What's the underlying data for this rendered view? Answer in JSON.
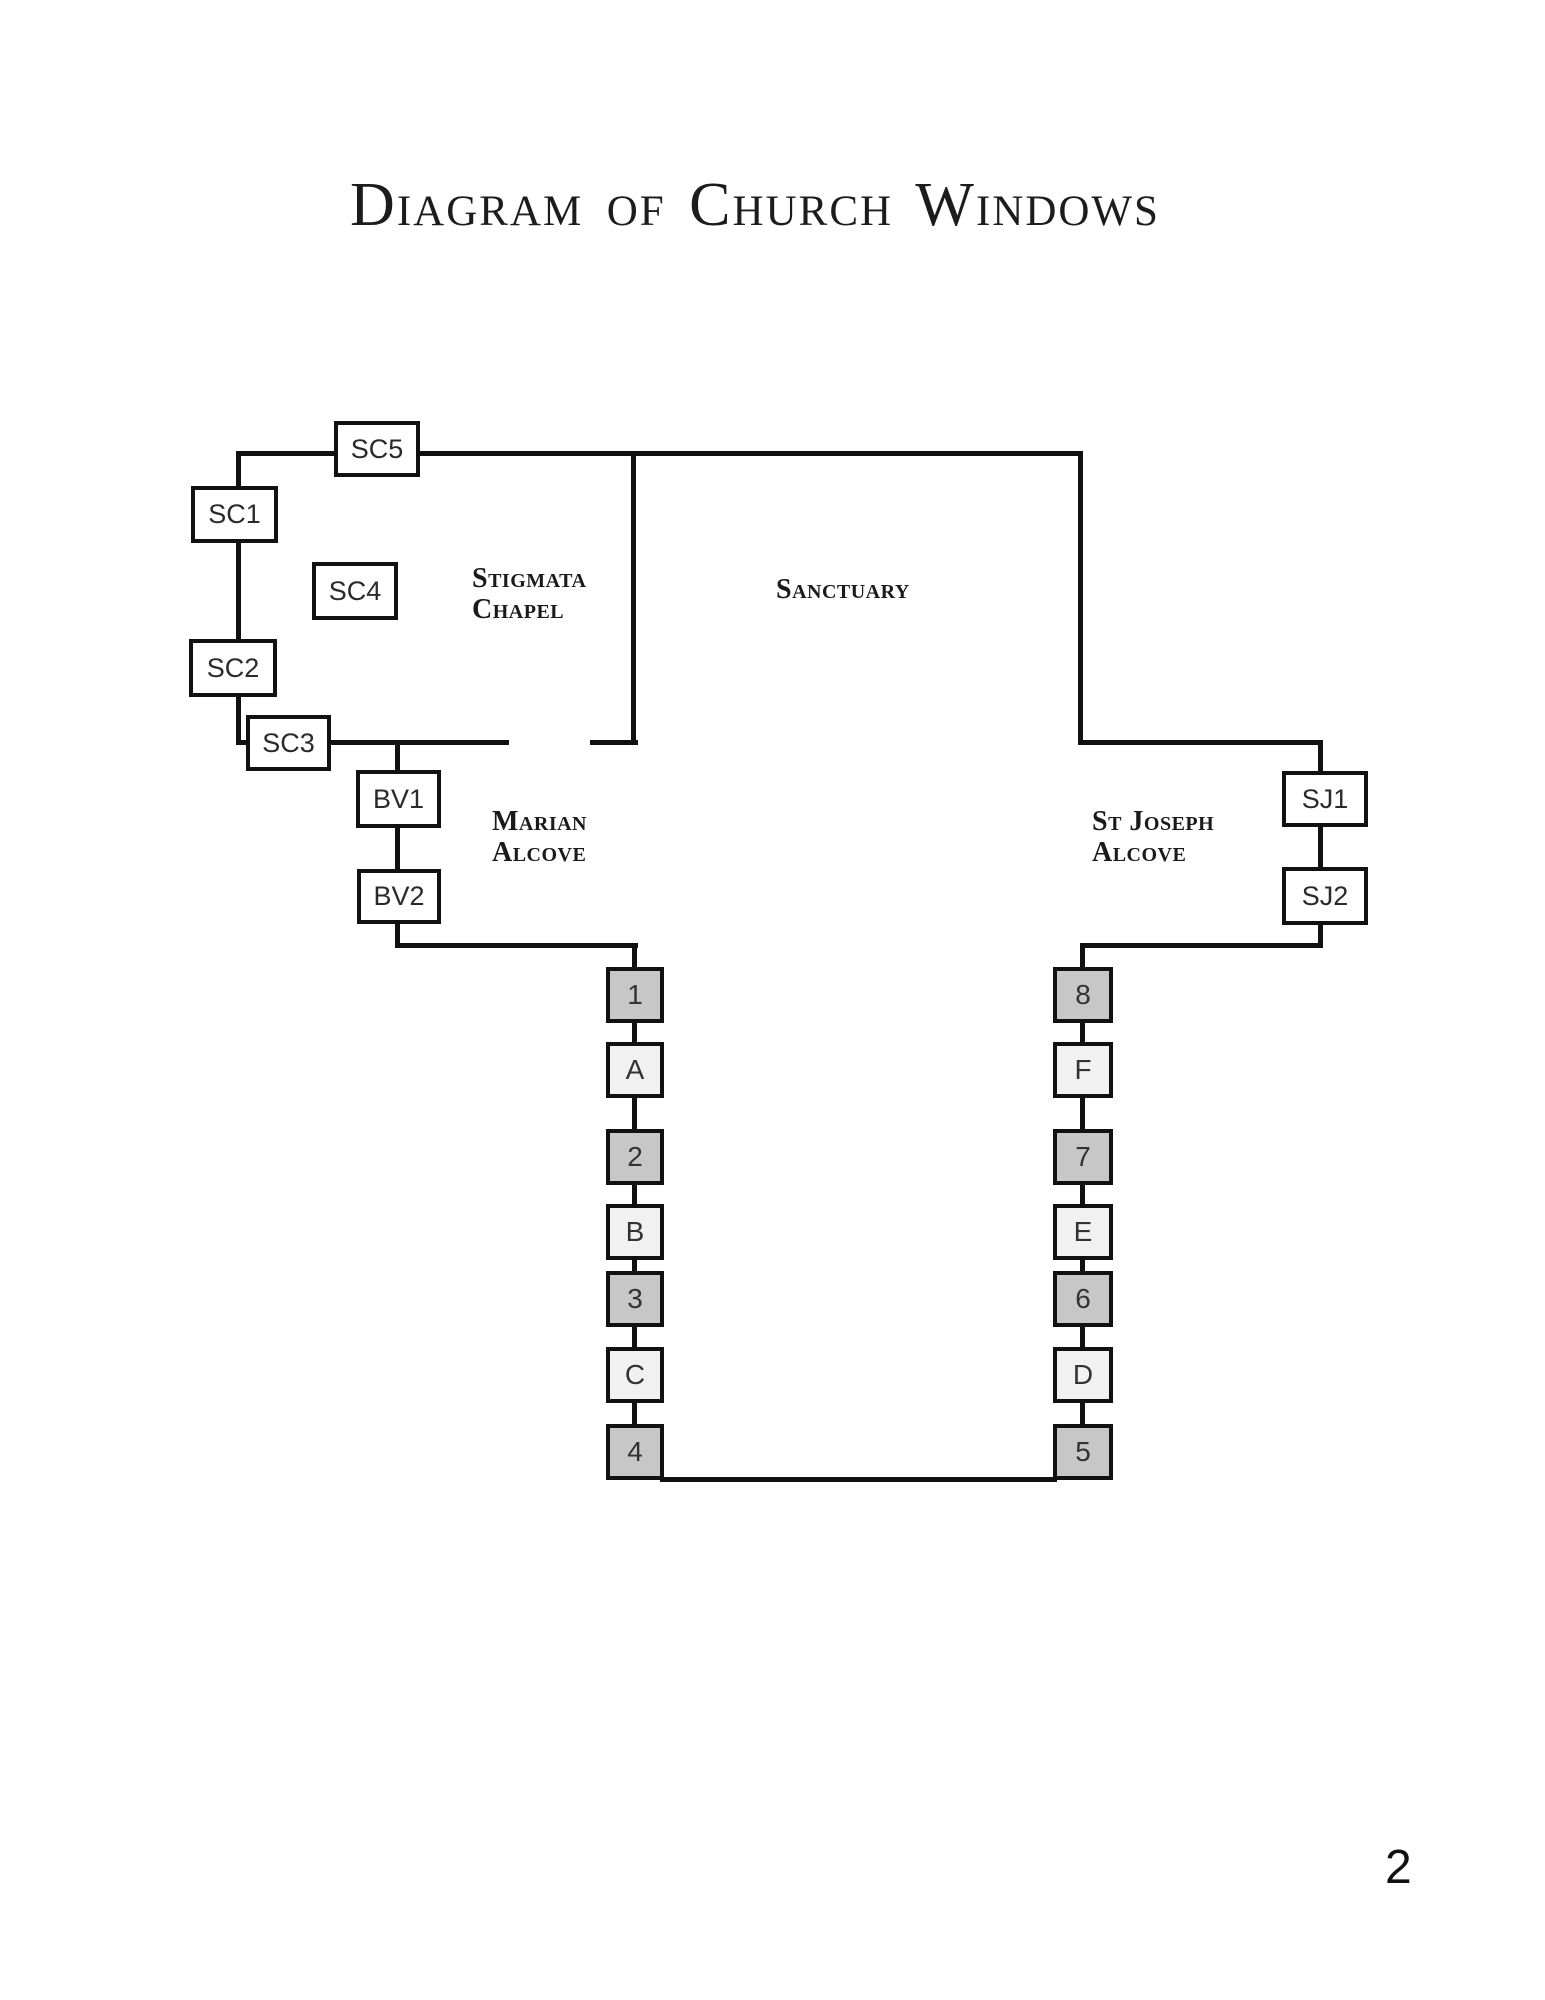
{
  "page": {
    "title": "Diagram of Church Windows",
    "page_number": "2"
  },
  "areas": {
    "stigmata_chapel": {
      "line1": "Stigmata",
      "line2": "Chapel"
    },
    "sanctuary": {
      "label": "Sanctuary"
    },
    "marian_alcove": {
      "line1": "Marian",
      "line2": "Alcove"
    },
    "st_joseph_alcove": {
      "line1": "St Joseph",
      "line2": "Alcove"
    }
  },
  "windows": {
    "sc5": "SC5",
    "sc1": "SC1",
    "sc4": "SC4",
    "sc2": "SC2",
    "sc3": "SC3",
    "bv1": "BV1",
    "bv2": "BV2",
    "sj1": "SJ1",
    "sj2": "SJ2",
    "left_nave": [
      "1",
      "A",
      "2",
      "B",
      "3",
      "C",
      "4"
    ],
    "right_nave": [
      "8",
      "F",
      "7",
      "E",
      "6",
      "D",
      "5"
    ]
  },
  "colors": {
    "wall": "#111111",
    "window_fill": "#ffffff",
    "numbered_window_fill": "#c7c7c7",
    "lettered_window_fill": "#f1f1f1",
    "text": "#1a1a1a"
  }
}
